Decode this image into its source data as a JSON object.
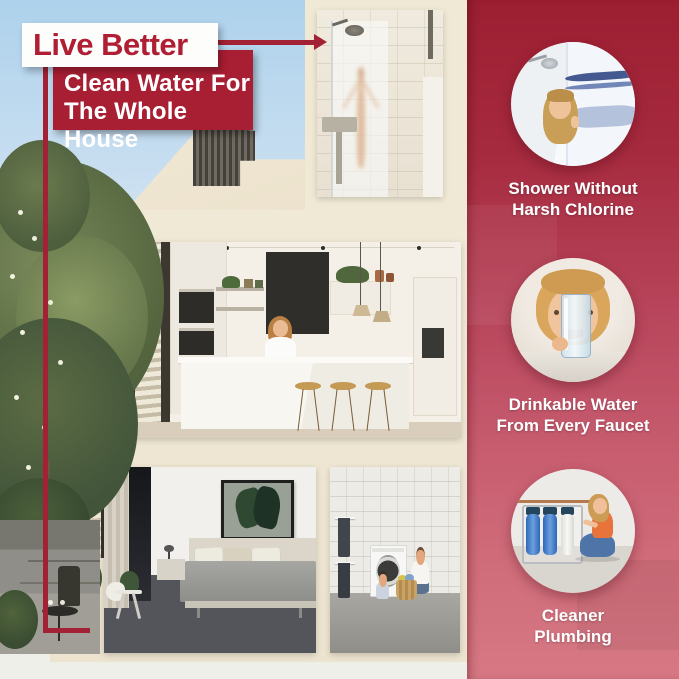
{
  "poster": {
    "background_color": "#F0E9D6",
    "accent_red": "#A81E33",
    "sky_blue": "#AED2EC"
  },
  "banner": {
    "title": "Live Better",
    "subtitle_line1": "Clean Water For",
    "subtitle_line2": "The Whole House"
  },
  "right_panel": {
    "gradient_top": "#9C1E31",
    "gradient_bottom": "#D67884",
    "features": [
      {
        "photo": "woman-peeking-past-shower-curtain",
        "caption_line1": "Shower Without",
        "caption_line2": "Harsh Chlorine"
      },
      {
        "photo": "woman-holding-glass-of-water",
        "caption_line1": "Drinkable Water",
        "caption_line2": "From Every Faucet"
      },
      {
        "photo": "woman-beside-whole-house-filter-system",
        "caption_line1": "Cleaner",
        "caption_line2": "Plumbing"
      }
    ]
  },
  "house_cutaway": {
    "scenes": [
      "shower-bathroom",
      "kitchen",
      "bedroom",
      "laundry-room",
      "garden-patio"
    ]
  }
}
